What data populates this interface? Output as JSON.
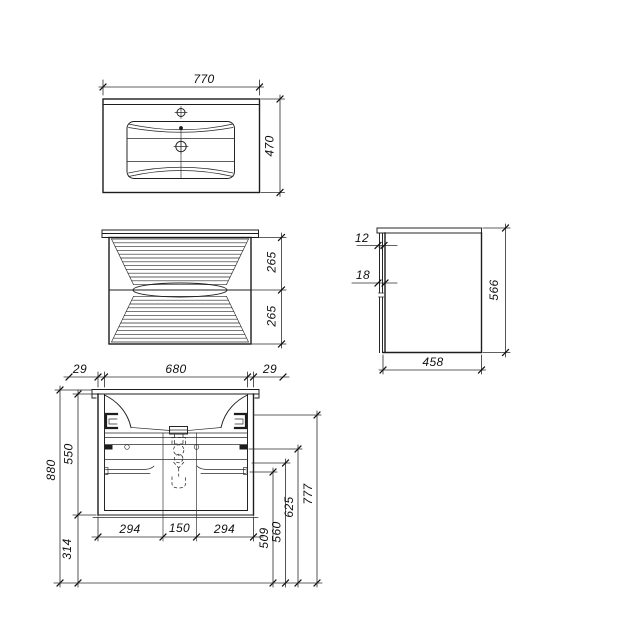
{
  "colors": {
    "background": "#ffffff",
    "line": "#1d1d1d"
  },
  "top_view": {
    "width": "770",
    "depth": "470"
  },
  "front_view": {
    "top_drawer_height": "265",
    "bottom_drawer_height": "265"
  },
  "side_view": {
    "top_offset": "12",
    "front_thickness": "18",
    "height": "566",
    "depth": "458"
  },
  "section_view": {
    "side_left": "29",
    "opening_width": "680",
    "side_right": "29",
    "overall_height": "880",
    "carcass_height": "550",
    "under_clearance": "314",
    "drawer_left": "294",
    "siphon_gap": "150",
    "drawer_right": "294",
    "level_509": "509",
    "level_560": "560",
    "level_625": "625",
    "level_777": "777"
  }
}
